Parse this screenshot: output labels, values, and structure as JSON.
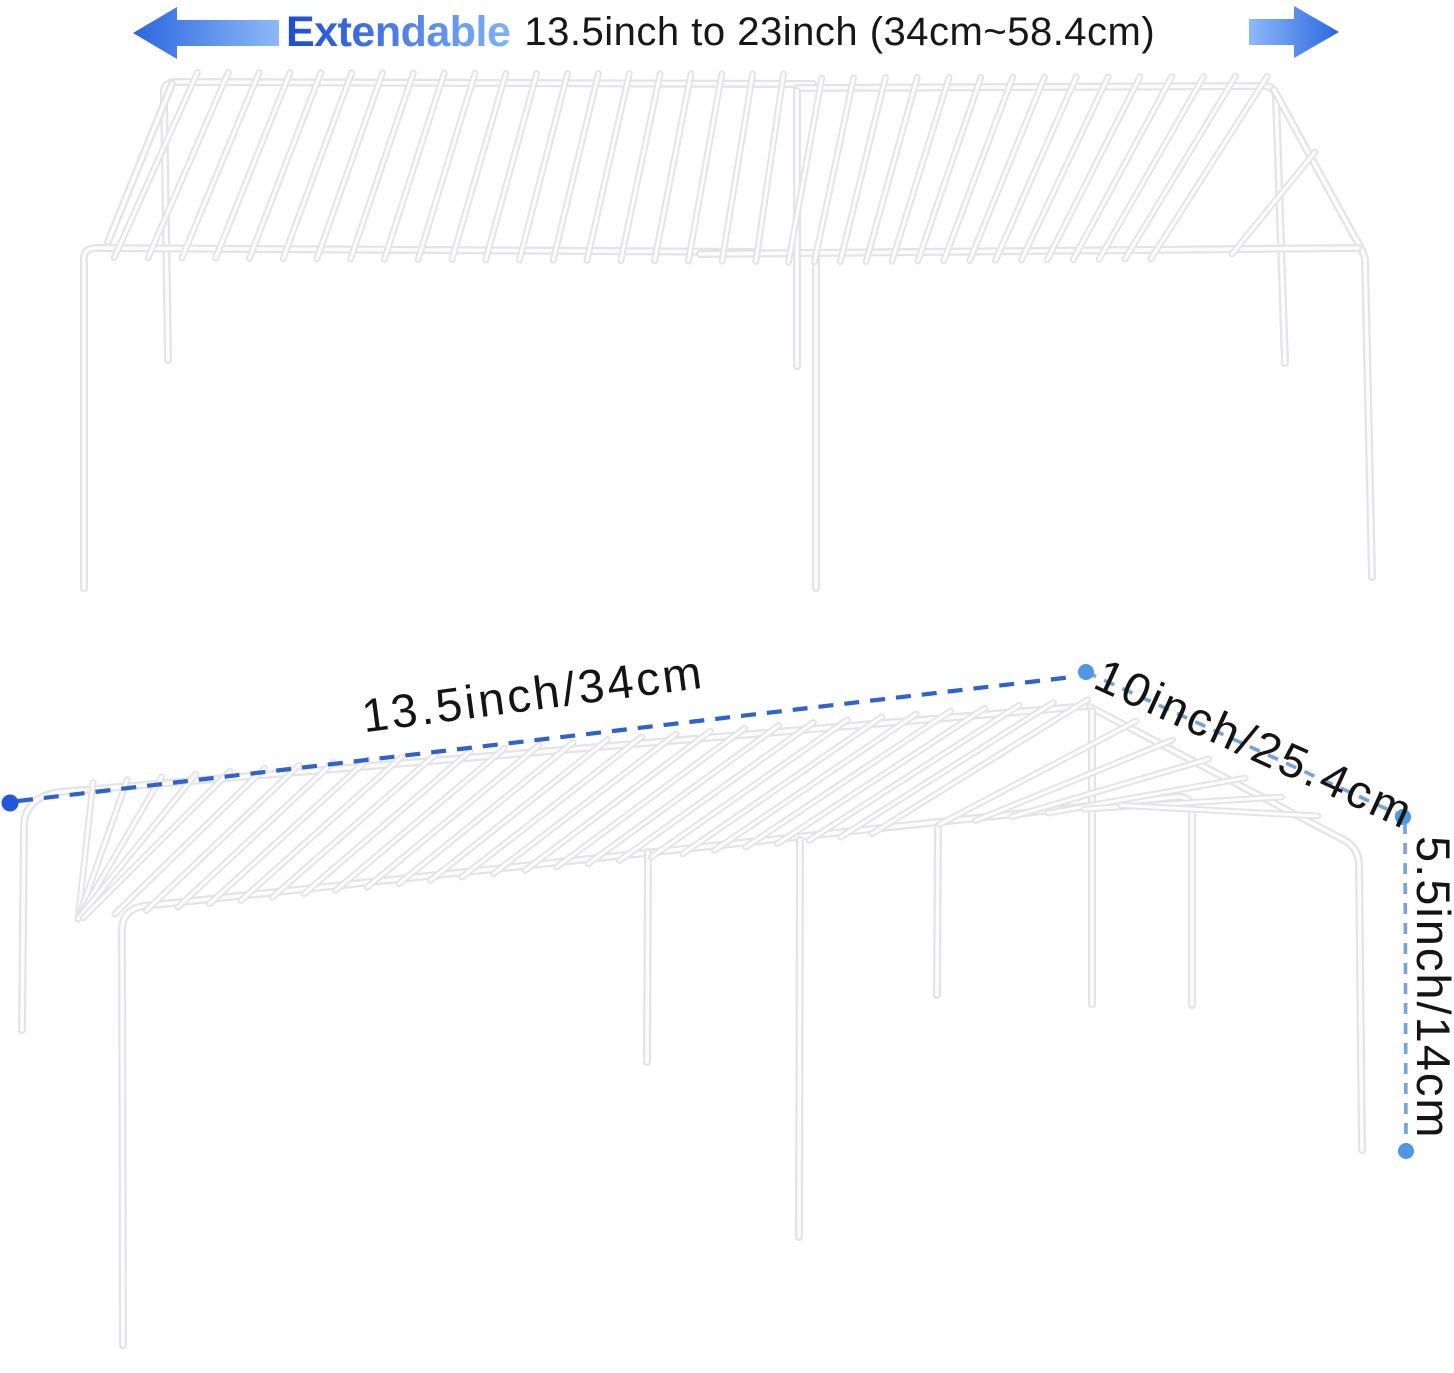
{
  "header": {
    "highlight_label": "Extendable",
    "range_label": "13.5inch to 23inch (34cm~58.4cm)",
    "text_color": "#171717",
    "highlight_gradient": [
      "#1c4bd6",
      "#7fb2f9"
    ],
    "arrow_gradient": [
      "#2b66e0",
      "#8db9f8"
    ]
  },
  "annotations": {
    "length_label": "13.5inch/34cm",
    "depth_label": "10inch/25.4cm",
    "height_label": "5.5inch/14cm",
    "label_color": "#141414",
    "length_line_color": "#2e62cc",
    "length_dot_color": "#2257dd",
    "secondary_line_color": "#74a3dd",
    "secondary_dot_color": "#4f97e3"
  },
  "product": {
    "wire_edge_color": "#e3e3e8",
    "wire_core_color": "#fcfcfd",
    "background_color": "#ffffff"
  }
}
